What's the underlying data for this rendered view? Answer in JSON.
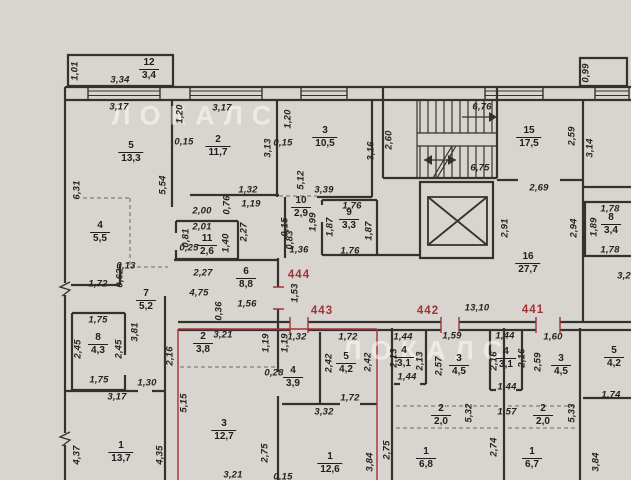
{
  "colors": {
    "background": "#d8d4cf",
    "wall": "#35322d",
    "red": "#a23236",
    "dim_text": "#26241f",
    "watermark": "rgba(252,251,247,0.55)"
  },
  "watermark": {
    "text": "ЛОКАЛС",
    "positions": [
      {
        "x": 196,
        "y": 116
      },
      {
        "x": 427,
        "y": 351
      }
    ]
  },
  "apartments": [
    {
      "n": "444",
      "x": 299,
      "y": 275
    },
    {
      "n": "443",
      "x": 322,
      "y": 311
    },
    {
      "n": "442",
      "x": 428,
      "y": 311
    },
    {
      "n": "441",
      "x": 533,
      "y": 310
    }
  ],
  "rooms": [
    {
      "n": "12",
      "a": "3,4",
      "x": 149,
      "y": 69
    },
    {
      "n": "5",
      "a": "13,3",
      "x": 131,
      "y": 152
    },
    {
      "n": "2",
      "a": "11,7",
      "x": 218,
      "y": 146
    },
    {
      "n": "3",
      "a": "10,5",
      "x": 325,
      "y": 137
    },
    {
      "n": "10",
      "a": "2,9",
      "x": 301,
      "y": 207
    },
    {
      "n": "9",
      "a": "3,3",
      "x": 349,
      "y": 219
    },
    {
      "n": "11",
      "a": "2,6",
      "x": 207,
      "y": 245
    },
    {
      "n": "4",
      "a": "5,5",
      "x": 100,
      "y": 232
    },
    {
      "n": "7",
      "a": "5,2",
      "x": 146,
      "y": 300
    },
    {
      "n": "6",
      "a": "8,8",
      "x": 246,
      "y": 278
    },
    {
      "n": "8",
      "a": "4,3",
      "x": 98,
      "y": 344
    },
    {
      "n": "1",
      "a": "13,7",
      "x": 121,
      "y": 452
    },
    {
      "n": "15",
      "a": "17,5",
      "x": 529,
      "y": 137
    },
    {
      "n": "16",
      "a": "27,7",
      "x": 528,
      "y": 263
    },
    {
      "n": "8",
      "a": "3,4",
      "x": 611,
      "y": 224
    },
    {
      "n": "2",
      "a": "3,8",
      "x": 203,
      "y": 343
    },
    {
      "n": "3",
      "a": "12,7",
      "x": 224,
      "y": 430
    },
    {
      "n": "4",
      "a": "3,9",
      "x": 293,
      "y": 377
    },
    {
      "n": "5",
      "a": "4,2",
      "x": 346,
      "y": 363
    },
    {
      "n": "1",
      "a": "12,6",
      "x": 330,
      "y": 463
    },
    {
      "n": "4",
      "a": "3,1",
      "x": 404,
      "y": 357
    },
    {
      "n": "3",
      "a": "4,5",
      "x": 459,
      "y": 365
    },
    {
      "n": "2",
      "a": "2,0",
      "x": 441,
      "y": 415
    },
    {
      "n": "1",
      "a": "6,8",
      "x": 426,
      "y": 458
    },
    {
      "n": "4",
      "a": "3,1",
      "x": 506,
      "y": 358
    },
    {
      "n": "3",
      "a": "4,5",
      "x": 561,
      "y": 365
    },
    {
      "n": "2",
      "a": "2,0",
      "x": 543,
      "y": 415
    },
    {
      "n": "1",
      "a": "6,7",
      "x": 532,
      "y": 458
    },
    {
      "n": "5",
      "a": "4,2",
      "x": 614,
      "y": 357
    }
  ],
  "dimensions": [
    {
      "t": "1,01",
      "x": 75,
      "y": 71,
      "r": 1
    },
    {
      "t": "3,34",
      "x": 120,
      "y": 80
    },
    {
      "t": "3,17",
      "x": 119,
      "y": 107
    },
    {
      "t": "1,20",
      "x": 180,
      "y": 114,
      "r": 1
    },
    {
      "t": "0,15",
      "x": 184,
      "y": 142
    },
    {
      "t": "3,17",
      "x": 222,
      "y": 108
    },
    {
      "t": "6,31",
      "x": 77,
      "y": 190,
      "r": 1
    },
    {
      "t": "5,54",
      "x": 163,
      "y": 185,
      "r": 1
    },
    {
      "t": "3,13",
      "x": 268,
      "y": 148,
      "r": 1
    },
    {
      "t": "1,32",
      "x": 248,
      "y": 190
    },
    {
      "t": "1,19",
      "x": 251,
      "y": 204
    },
    {
      "t": "2,00",
      "x": 202,
      "y": 211
    },
    {
      "t": "0,76",
      "x": 227,
      "y": 205,
      "r": 1
    },
    {
      "t": "1,20",
      "x": 288,
      "y": 119,
      "r": 1
    },
    {
      "t": "0,15",
      "x": 283,
      "y": 143
    },
    {
      "t": "3,16",
      "x": 371,
      "y": 151,
      "r": 1
    },
    {
      "t": "5,12",
      "x": 301,
      "y": 180,
      "r": 1
    },
    {
      "t": "3,39",
      "x": 324,
      "y": 190
    },
    {
      "t": "2,60",
      "x": 389,
      "y": 140,
      "r": 1
    },
    {
      "t": "6,76",
      "x": 482,
      "y": 107
    },
    {
      "t": "6,75",
      "x": 480,
      "y": 168
    },
    {
      "t": "2,59",
      "x": 572,
      "y": 136,
      "r": 1
    },
    {
      "t": "0,99",
      "x": 586,
      "y": 73,
      "r": 1
    },
    {
      "t": "3,14",
      "x": 590,
      "y": 148,
      "r": 1
    },
    {
      "t": "2,69",
      "x": 539,
      "y": 188
    },
    {
      "t": "2,91",
      "x": 505,
      "y": 228,
      "r": 1
    },
    {
      "t": "1,78",
      "x": 610,
      "y": 209
    },
    {
      "t": "1,89",
      "x": 594,
      "y": 227,
      "r": 1
    },
    {
      "t": "2,94",
      "x": 574,
      "y": 228,
      "r": 1
    },
    {
      "t": "1,78",
      "x": 610,
      "y": 250
    },
    {
      "t": "3,2",
      "x": 624,
      "y": 276
    },
    {
      "t": "2,01",
      "x": 202,
      "y": 227
    },
    {
      "t": "0,81",
      "x": 186,
      "y": 238,
      "r": 1
    },
    {
      "t": "0,25",
      "x": 189,
      "y": 248
    },
    {
      "t": "1,40",
      "x": 226,
      "y": 243,
      "r": 1
    },
    {
      "t": "2,27",
      "x": 244,
      "y": 232,
      "r": 1
    },
    {
      "t": "1,99",
      "x": 313,
      "y": 222,
      "r": 1
    },
    {
      "t": "1,76",
      "x": 352,
      "y": 206
    },
    {
      "t": "1,87",
      "x": 330,
      "y": 227,
      "r": 1
    },
    {
      "t": "1,87",
      "x": 369,
      "y": 231,
      "r": 1
    },
    {
      "t": "1,76",
      "x": 350,
      "y": 251
    },
    {
      "t": "0,83",
      "x": 290,
      "y": 240,
      "r": 1
    },
    {
      "t": "1,36",
      "x": 299,
      "y": 250
    },
    {
      "t": "0,15",
      "x": 285,
      "y": 227,
      "r": 1
    },
    {
      "t": "0,13",
      "x": 126,
      "y": 266
    },
    {
      "t": "0,62",
      "x": 120,
      "y": 278,
      "r": 1
    },
    {
      "t": "1,72",
      "x": 98,
      "y": 284
    },
    {
      "t": "2,27",
      "x": 203,
      "y": 273
    },
    {
      "t": "4,75",
      "x": 199,
      "y": 293
    },
    {
      "t": "1,56",
      "x": 247,
      "y": 304
    },
    {
      "t": "1,53",
      "x": 295,
      "y": 293,
      "r": 1
    },
    {
      "t": "0,36",
      "x": 219,
      "y": 311,
      "r": 1
    },
    {
      "t": "1,75",
      "x": 98,
      "y": 320
    },
    {
      "t": "2,45",
      "x": 78,
      "y": 349,
      "r": 1
    },
    {
      "t": "2,45",
      "x": 119,
      "y": 349,
      "r": 1
    },
    {
      "t": "1,75",
      "x": 99,
      "y": 380
    },
    {
      "t": "3,81",
      "x": 135,
      "y": 332,
      "r": 1
    },
    {
      "t": "3,17",
      "x": 117,
      "y": 397
    },
    {
      "t": "1,30",
      "x": 147,
      "y": 383
    },
    {
      "t": "2,16",
      "x": 170,
      "y": 356,
      "r": 1
    },
    {
      "t": "4,37",
      "x": 77,
      "y": 455,
      "r": 1
    },
    {
      "t": "4,35",
      "x": 160,
      "y": 455,
      "r": 1
    },
    {
      "t": "3,21",
      "x": 223,
      "y": 335
    },
    {
      "t": "5,15",
      "x": 184,
      "y": 403,
      "r": 1
    },
    {
      "t": "3,21",
      "x": 233,
      "y": 475
    },
    {
      "t": "0,28",
      "x": 274,
      "y": 373
    },
    {
      "t": "1,19",
      "x": 266,
      "y": 343,
      "r": 1
    },
    {
      "t": "1,19",
      "x": 285,
      "y": 343,
      "r": 1
    },
    {
      "t": "1,32",
      "x": 297,
      "y": 337
    },
    {
      "t": "1,72",
      "x": 348,
      "y": 337
    },
    {
      "t": "2,42",
      "x": 329,
      "y": 363,
      "r": 1
    },
    {
      "t": "2,42",
      "x": 368,
      "y": 362,
      "r": 1
    },
    {
      "t": "1,72",
      "x": 350,
      "y": 398
    },
    {
      "t": "3,32",
      "x": 324,
      "y": 412
    },
    {
      "t": "2,75",
      "x": 265,
      "y": 453,
      "r": 1
    },
    {
      "t": "3,84",
      "x": 370,
      "y": 462,
      "r": 1
    },
    {
      "t": "0,15",
      "x": 283,
      "y": 477
    },
    {
      "t": "13,10",
      "x": 477,
      "y": 308
    },
    {
      "t": "1,59",
      "x": 452,
      "y": 336
    },
    {
      "t": "2,57",
      "x": 439,
      "y": 366,
      "r": 1
    },
    {
      "t": "1,44",
      "x": 403,
      "y": 337
    },
    {
      "t": "2,13",
      "x": 394,
      "y": 358,
      "r": 1
    },
    {
      "t": "2,13",
      "x": 420,
      "y": 361,
      "r": 1
    },
    {
      "t": "1,44",
      "x": 407,
      "y": 377
    },
    {
      "t": "5,32",
      "x": 469,
      "y": 413,
      "r": 1
    },
    {
      "t": "2,75",
      "x": 387,
      "y": 450,
      "r": 1
    },
    {
      "t": "1,44",
      "x": 505,
      "y": 336
    },
    {
      "t": "2,16",
      "x": 494,
      "y": 361,
      "r": 1
    },
    {
      "t": "2,16",
      "x": 522,
      "y": 358,
      "r": 1
    },
    {
      "t": "1,44",
      "x": 507,
      "y": 387
    },
    {
      "t": "1,60",
      "x": 553,
      "y": 337
    },
    {
      "t": "2,59",
      "x": 538,
      "y": 362,
      "r": 1
    },
    {
      "t": "1,57",
      "x": 507,
      "y": 412
    },
    {
      "t": "5,33",
      "x": 572,
      "y": 413,
      "r": 1
    },
    {
      "t": "2,74",
      "x": 494,
      "y": 447,
      "r": 1
    },
    {
      "t": "1,74",
      "x": 611,
      "y": 395
    },
    {
      "t": "3,84",
      "x": 596,
      "y": 462,
      "r": 1
    }
  ]
}
